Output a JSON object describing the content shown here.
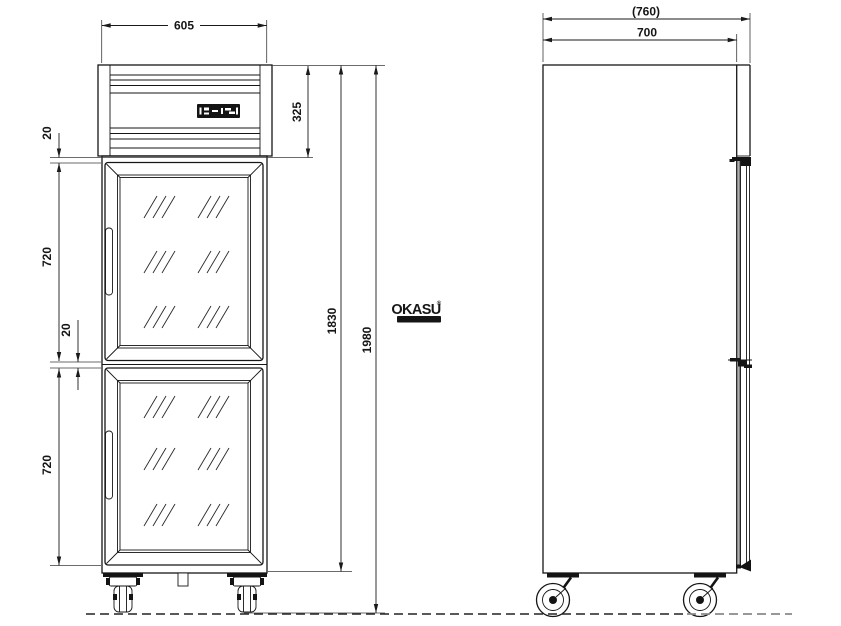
{
  "dims_front": {
    "width": "605",
    "top_height": "325",
    "gap_top": "20",
    "door_upper": "720",
    "gap_mid": "20",
    "door_lower": "720",
    "height_body": "1830",
    "height_total": "1980"
  },
  "dims_side": {
    "depth_overall": "(760)",
    "depth_body": "700"
  },
  "logo": {
    "brand": "OKASU",
    "reg": "®",
    "tagline": "••••••••••"
  },
  "colors": {
    "line": "#161616",
    "gasket": "#b0b0b0",
    "watermark": "#151515",
    "ground_secondary": "#8a8a8a"
  }
}
